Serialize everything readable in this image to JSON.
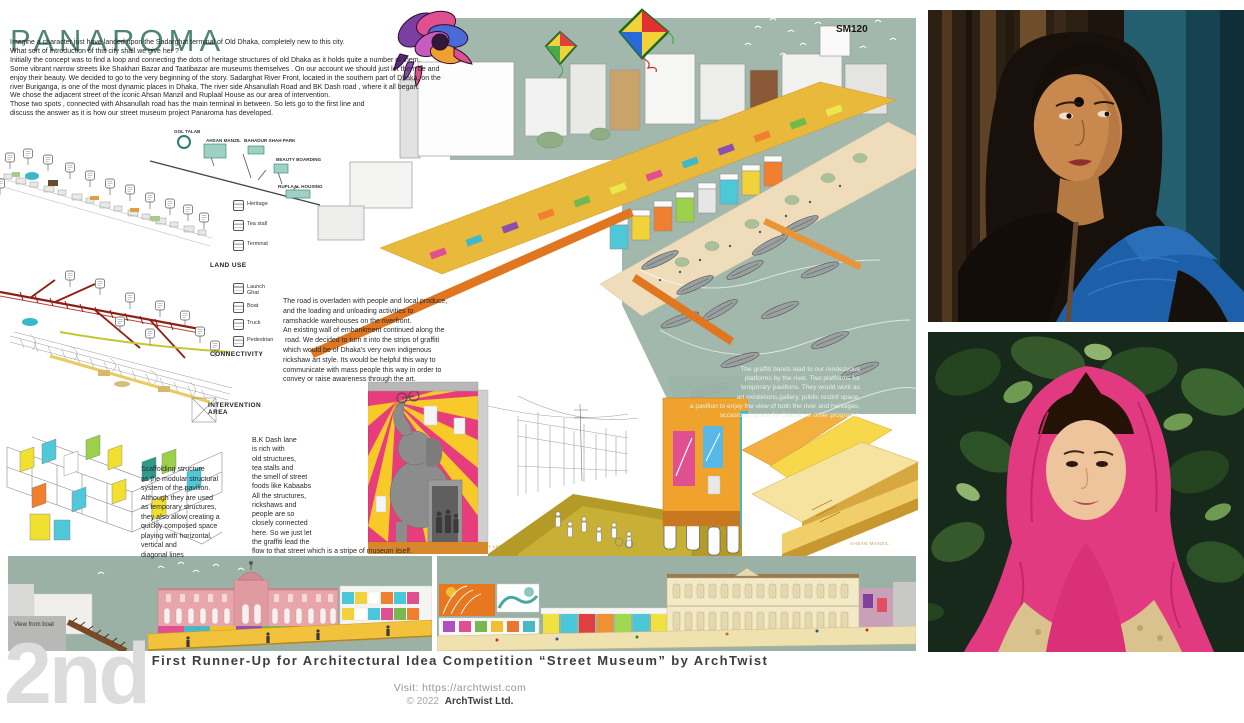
{
  "poster": {
    "title": "PANAROMA",
    "code": "SM120",
    "intro": "Imagine a character just have landed upon the Sadarghat terminal of Old Dhaka, completely new to this city.\nWhat sort of introduction of this city shall we give her ?\nInitially the concept was to find a loop and connecting the dots of heritage structures of old Dhaka as it holds quite a number of them.\nSome vibrant narrow streets like Shakhari Bazar and Taatibazar are museums themselves . On our account we should just let them be and\nenjoy their beauty. We decided to go to the very beginning of the story. Sadarghat River Front, located in the southern part of Dhaka, on the\nriver Buriganga, is one of the most dynamic places in Dhaka. The river side Ahsanullah Road and BK Dash road , where it all began.\nWe chose the adjacent street of the iconic Ahsan Manzil and Ruplaal House as our area of intervention.\nThose two spots , connected with Ahsanullah road has the main terminal in between. So lets go to the first line and\ndiscuss the answer as it is how our street museum project Panaroma has developed.",
    "map_labels": {
      "gol_talab": "GOL TALAB",
      "ahsan_manzil": "AHSAN MANZIL",
      "bahadur_shah_park": "BAHADUR SHAH PARK",
      "beauty_boarding": "BEAUTY BOARDING",
      "ruplaal_housing": "RUPLAAL HOUSING"
    },
    "section_labels": {
      "land_use": "LAND USE",
      "connectivity": "CONNECTIVITY",
      "intervention": "INTERVENTION\nAREA"
    },
    "land_use_legend": [
      "Heritage",
      "Tea stall",
      "Terminal"
    ],
    "connectivity_legend": [
      "Launch\nGhat",
      "Boat",
      "Truck",
      "Pedestrian"
    ],
    "road_text": "The road is overladen with people and local produce,\nand the loading and unloading activities to\nramshackle warehouses on the riverfront.\nAn existing wall of embankment continued along the\n road. We decided to turn it into the strips of graffiti\nwhich would be of Dhaka's very own indigenous\nrickshaw art style. Its would be helpful this way to\ncommunicate with mass people this way in order to\nconvey or raise awareness through the art.",
    "graffiti_text": "The graffiti bands lead to our rendezvous\nplatforms by the river. Two platforms for\ntemporary pavilions. They would work as\nart exhibitions,gallery, public restinf space,\na pavilion to enjoy the view of both the river and heritages,\noccasional space for Sakrain or other programs.",
    "scaffolding_text": "Scaffolding structure\nas the modular structural\nsystem of the pavilion.\nAlthough they are used\nas temporary structures,\nthey also allow creating a\nquickly composed space\nplaying with horizontal,\nvertical and\ndiagonal lines",
    "bkdash_text": "B.K Dash lane\nis rich with\nold structures,\ntea stalls and\nthe smell of street\nfoods like Kabaabs\nAll the structures,\nrickshaws and\npeople are so\nclosely connected\nhere. So we just let\nthe graffiti lead the\nflow to that street which is a stripe of museum itself.",
    "captions": {
      "bk_dash_lane": "B.K DASH LANE",
      "ahsan_manzil": "AHSAN MANZIL",
      "view_from_boat": "View from boat"
    }
  },
  "footer": {
    "rank_watermark": "2nd",
    "award_line": "First Runner-Up for Architectural Idea Competition “Street Museum” by ArchTwist",
    "visit_line": "Visit: https://archtwist.com",
    "copyright_prefix": "© 2022",
    "copyright_name": "ArchTwist Ltd."
  },
  "colors": {
    "title_teal": "#4e8573",
    "sage_background": "#a3b8ad",
    "road_yellow": "#e9b93c",
    "pier_orange": "#e0761f",
    "mural_pink": "#e83d7c",
    "sunburst_yellow": "#f7c929",
    "connectivity_red": "#8f1f15",
    "hijab_pink": "#e23a80",
    "watermark_gray": "#dcdcdc"
  }
}
